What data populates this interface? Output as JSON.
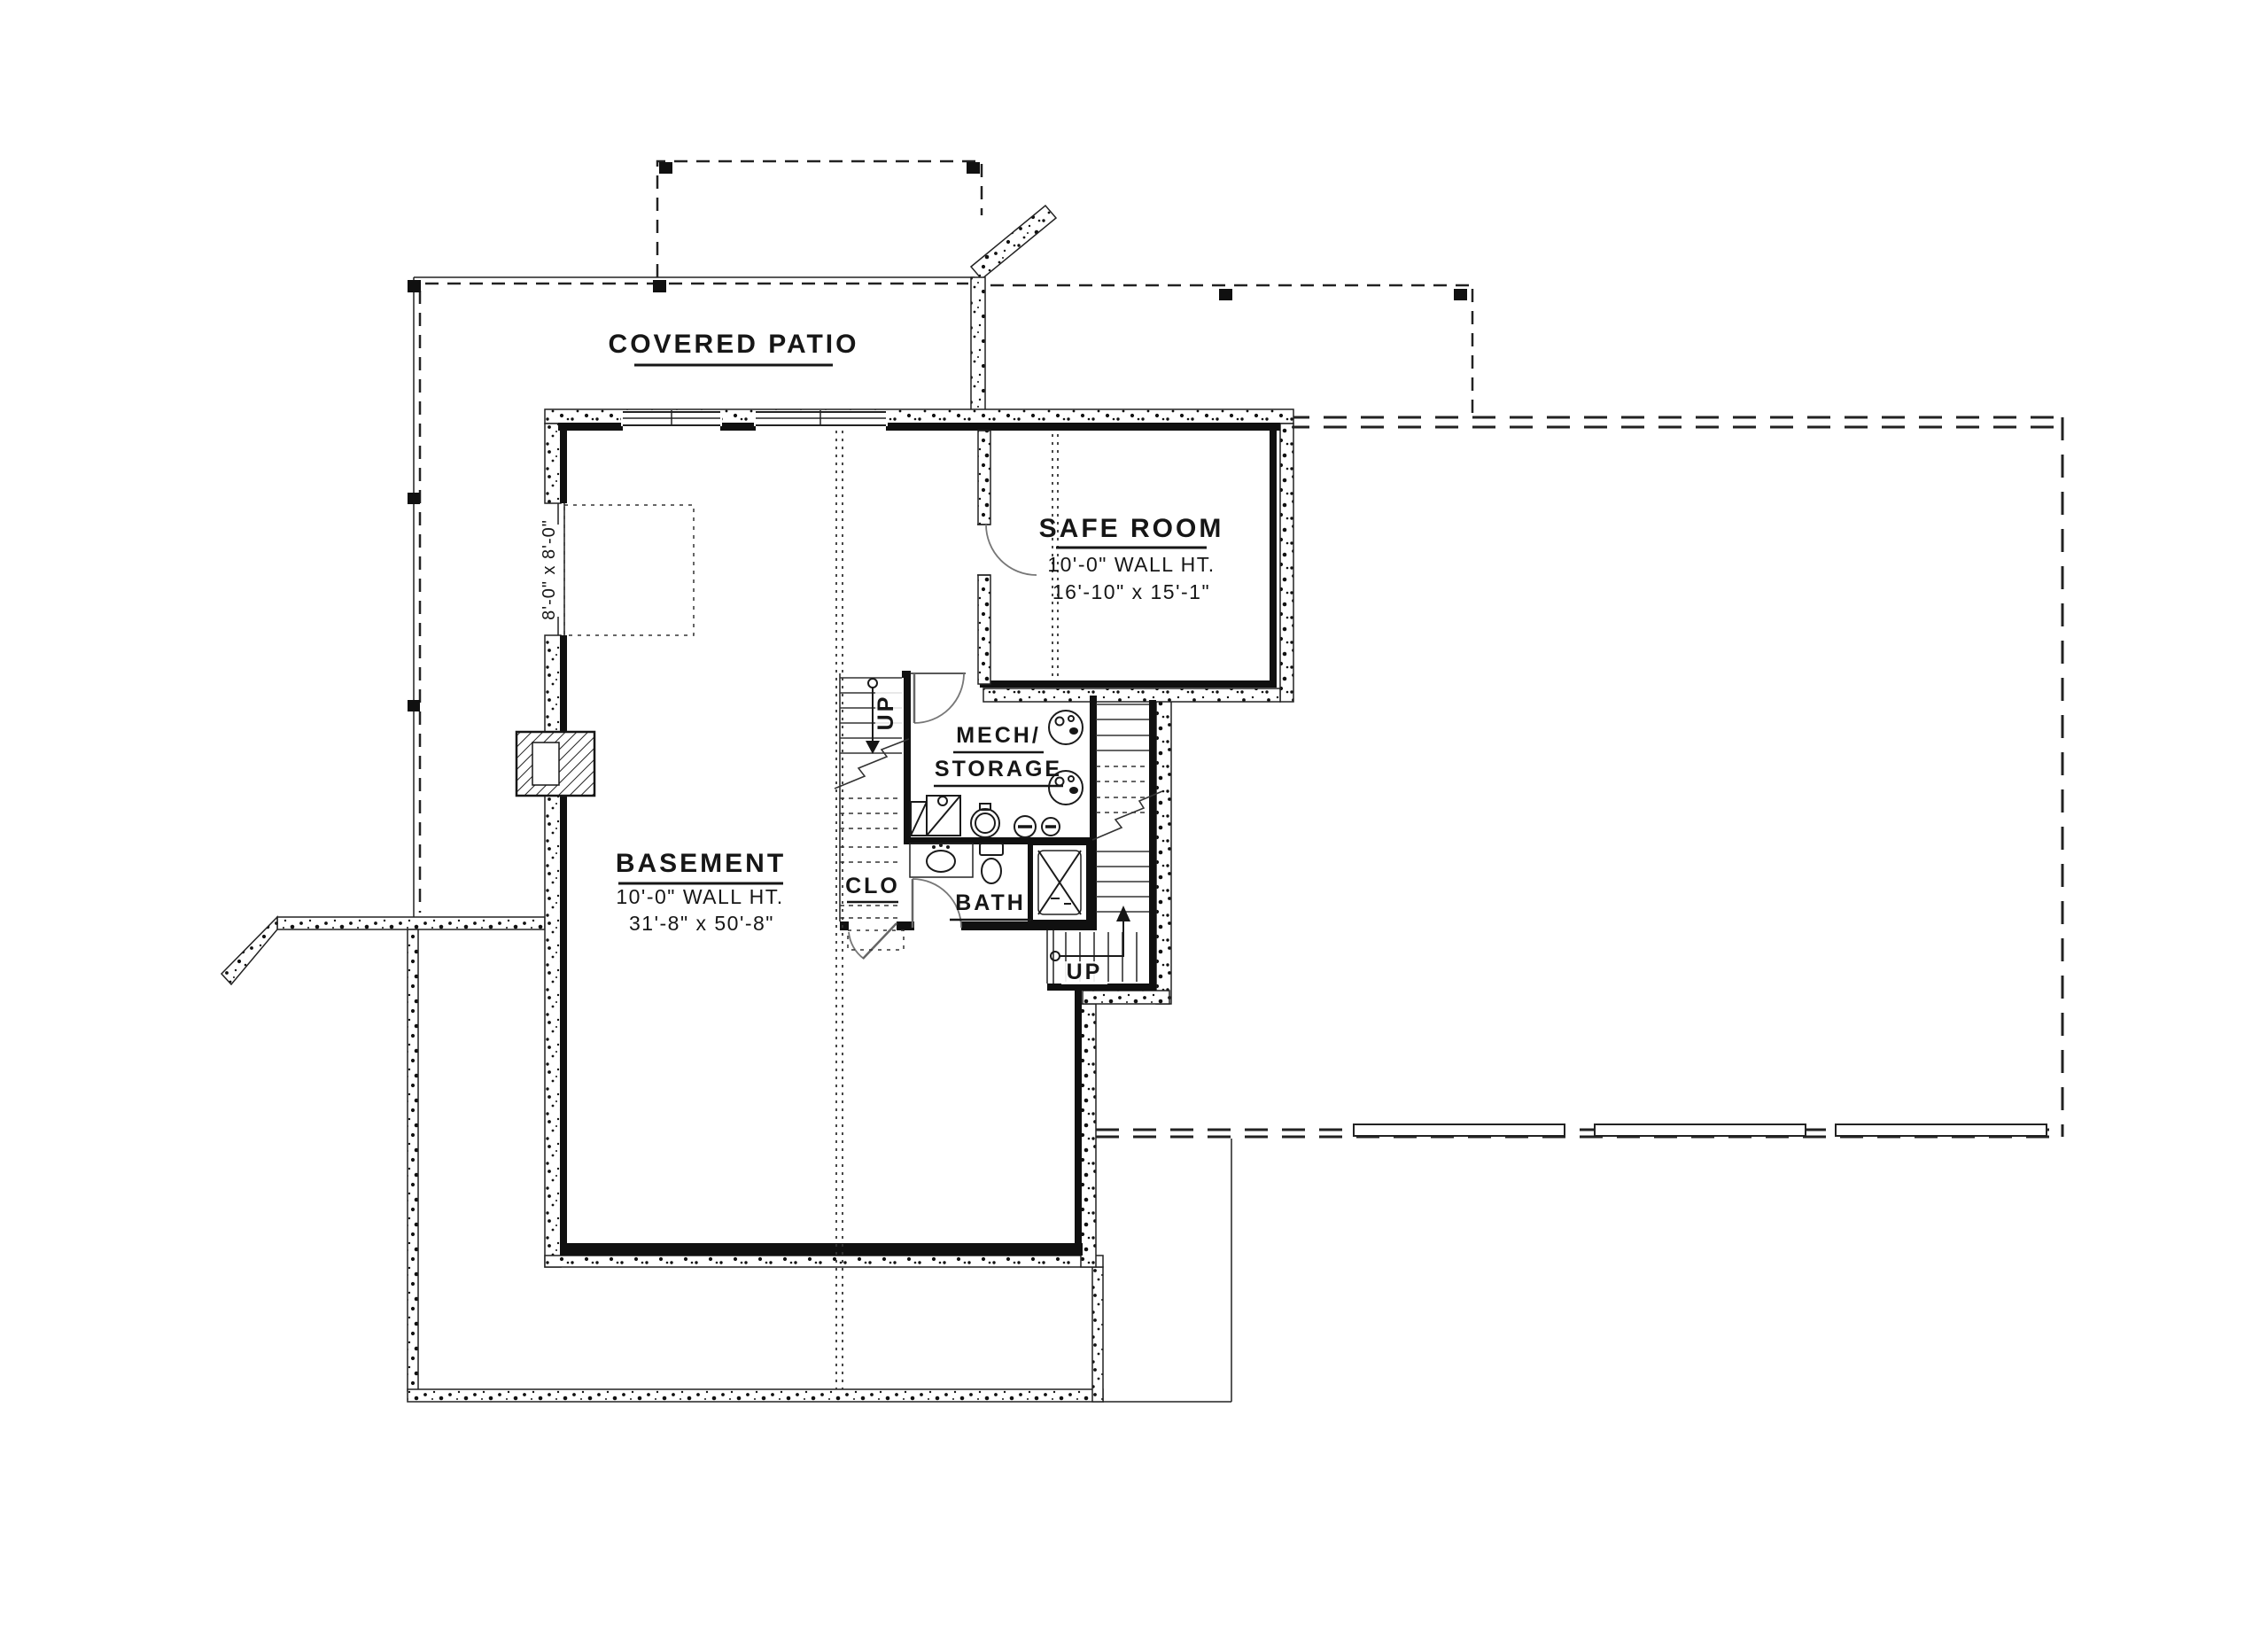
{
  "drawing_type": "basement floor plan",
  "colors": {
    "ink": "#161616",
    "paper": "#ffffff"
  },
  "labels": {
    "covered_patio": "COVERED PATIO",
    "safe_room_title": "SAFE ROOM",
    "safe_room_wall_ht": "10'-0\" WALL HT.",
    "safe_room_dims": "16'-10\" x 15'-1\"",
    "basement_title": "BASEMENT",
    "basement_wall_ht": "10'-0\" WALL HT.",
    "basement_dims": "31'-8\" x 50'-8\"",
    "mech_line1": "MECH/",
    "mech_line2": "STORAGE",
    "closet": "CLO",
    "bath": "BATH",
    "stair_up_left": "UP",
    "stair_up_right": "UP",
    "patio_door_dims": "8'-0\" x 8'-0\""
  }
}
